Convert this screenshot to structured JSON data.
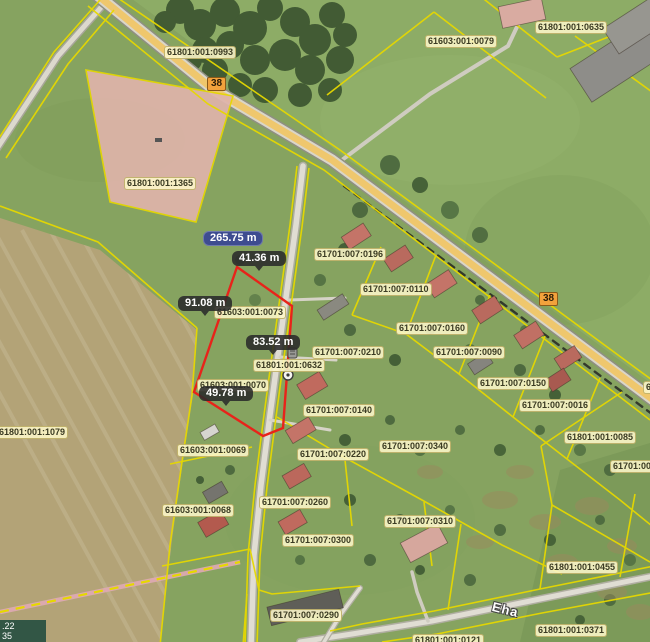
{
  "map": {
    "street_name": "Eha",
    "road_number": "38",
    "road_badges": [
      {
        "x": 207,
        "y": 77
      },
      {
        "x": 539,
        "y": 292
      }
    ],
    "parcel_labels": [
      {
        "text": "61801:001:0993",
        "x": 164,
        "y": 46
      },
      {
        "text": "61603:001:0079",
        "x": 425,
        "y": 35
      },
      {
        "text": "61801:001:0635",
        "x": 535,
        "y": 21
      },
      {
        "text": "61801:001:1365",
        "x": 124,
        "y": 177
      },
      {
        "text": "61701:007:0196",
        "x": 314,
        "y": 248
      },
      {
        "text": "61701:007:0110",
        "x": 360,
        "y": 283
      },
      {
        "text": "61701:007:0160",
        "x": 396,
        "y": 322
      },
      {
        "text": "61701:007:0210",
        "x": 312,
        "y": 346
      },
      {
        "text": "61701:007:0090",
        "x": 433,
        "y": 346
      },
      {
        "text": "61801:001:0632",
        "x": 253,
        "y": 359
      },
      {
        "text": "61603:001:0073",
        "x": 214,
        "y": 306
      },
      {
        "text": "61701:007:0150",
        "x": 477,
        "y": 377
      },
      {
        "text": "61603:001:0070",
        "x": 197,
        "y": 379
      },
      {
        "text": "61701:007:0140",
        "x": 303,
        "y": 404
      },
      {
        "text": "61701:007:0016",
        "x": 519,
        "y": 399
      },
      {
        "text": "61801:001:1079",
        "x": -4,
        "y": 426
      },
      {
        "text": "61801:001:0085",
        "x": 564,
        "y": 431
      },
      {
        "text": "61603:001:0069",
        "x": 177,
        "y": 444
      },
      {
        "text": "61701:007:0340",
        "x": 379,
        "y": 440
      },
      {
        "text": "61701:007:0220",
        "x": 297,
        "y": 448
      },
      {
        "text": "61701:00",
        "x": 610,
        "y": 460
      },
      {
        "text": "6",
        "x": 643,
        "y": 381
      },
      {
        "text": "61701:007:0260",
        "x": 259,
        "y": 496
      },
      {
        "text": "61603:001:0068",
        "x": 162,
        "y": 504
      },
      {
        "text": "61701:007:0310",
        "x": 384,
        "y": 515
      },
      {
        "text": "61701:007:0300",
        "x": 282,
        "y": 534
      },
      {
        "text": "61801:001:0455",
        "x": 546,
        "y": 561
      },
      {
        "text": "61701:007:0290",
        "x": 270,
        "y": 609
      },
      {
        "text": "61801:001:0371",
        "x": 535,
        "y": 624
      },
      {
        "text": "61801:001:0121",
        "x": 412,
        "y": 634
      }
    ],
    "measurements": {
      "total": {
        "text": "265.75 m",
        "x": 203,
        "y": 231
      },
      "segments": [
        {
          "text": "41.36 m",
          "x": 232,
          "y": 251
        },
        {
          "text": "91.08 m",
          "x": 178,
          "y": 296
        },
        {
          "text": "83.52 m",
          "x": 246,
          "y": 335
        },
        {
          "text": "49.78 m",
          "x": 199,
          "y": 386
        }
      ],
      "outline_color": "#e8231a",
      "total_badge_color": "#3e4c90"
    },
    "coordinate_readout": {
      "line1": ".22",
      "line2": "35"
    },
    "colors": {
      "parcel_line": "#e6d800",
      "label_bg": "#fdf7c9",
      "road_fill": "#efc76d",
      "pink_parcel": "#dfb4aa"
    }
  }
}
